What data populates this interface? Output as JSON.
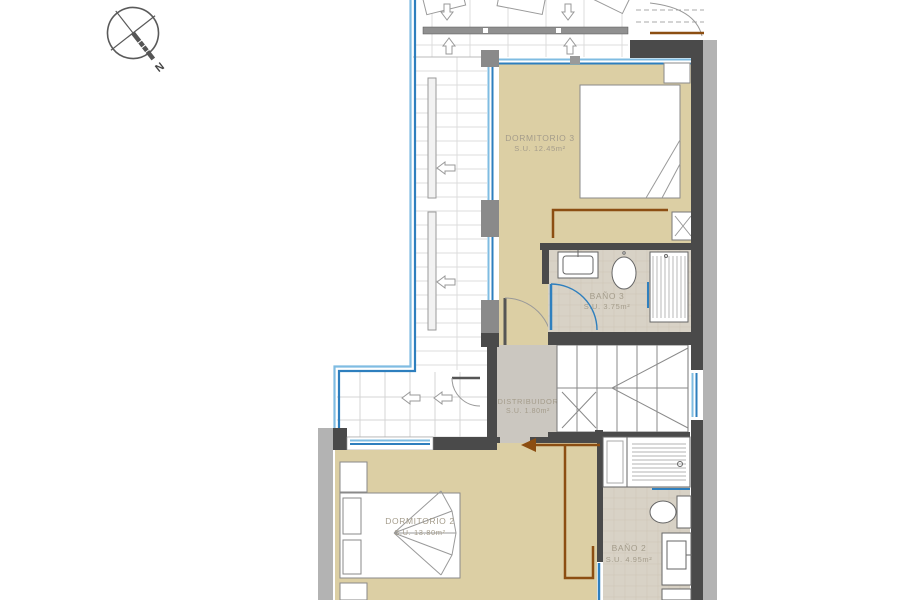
{
  "plan": {
    "title": "upper floor plan",
    "compass": {
      "label": "N"
    },
    "rooms": [
      {
        "id": "dormitorio3",
        "name": "DORMITORIO 3",
        "area": "S.U. 12.45m²"
      },
      {
        "id": "bano3",
        "name": "BAÑO 3",
        "area": "S.U. 3.75m²"
      },
      {
        "id": "distribuidor",
        "name": "DISTRIBUIDOR",
        "area": "S.U. 1.80m²"
      },
      {
        "id": "dormitorio2",
        "name": "DORMITORIO 2",
        "area": "S.U. 13.80m²"
      },
      {
        "id": "bano2",
        "name": "BAÑO 2",
        "area": "S.U. 4.95m²"
      }
    ],
    "colors": {
      "bedroom_floor": "#DCCFA4",
      "bath_tile": "#D8D2C6",
      "hall_floor": "#CBC7C0",
      "wall_dark": "#4A4A4A",
      "wall_light": "#B3B3B3",
      "glass_blue_dark": "#2E7FBE",
      "glass_blue_light": "#7FBCE2",
      "escape_route_brown": "#8C4E12",
      "label_gray": "#A49C8B"
    }
  }
}
